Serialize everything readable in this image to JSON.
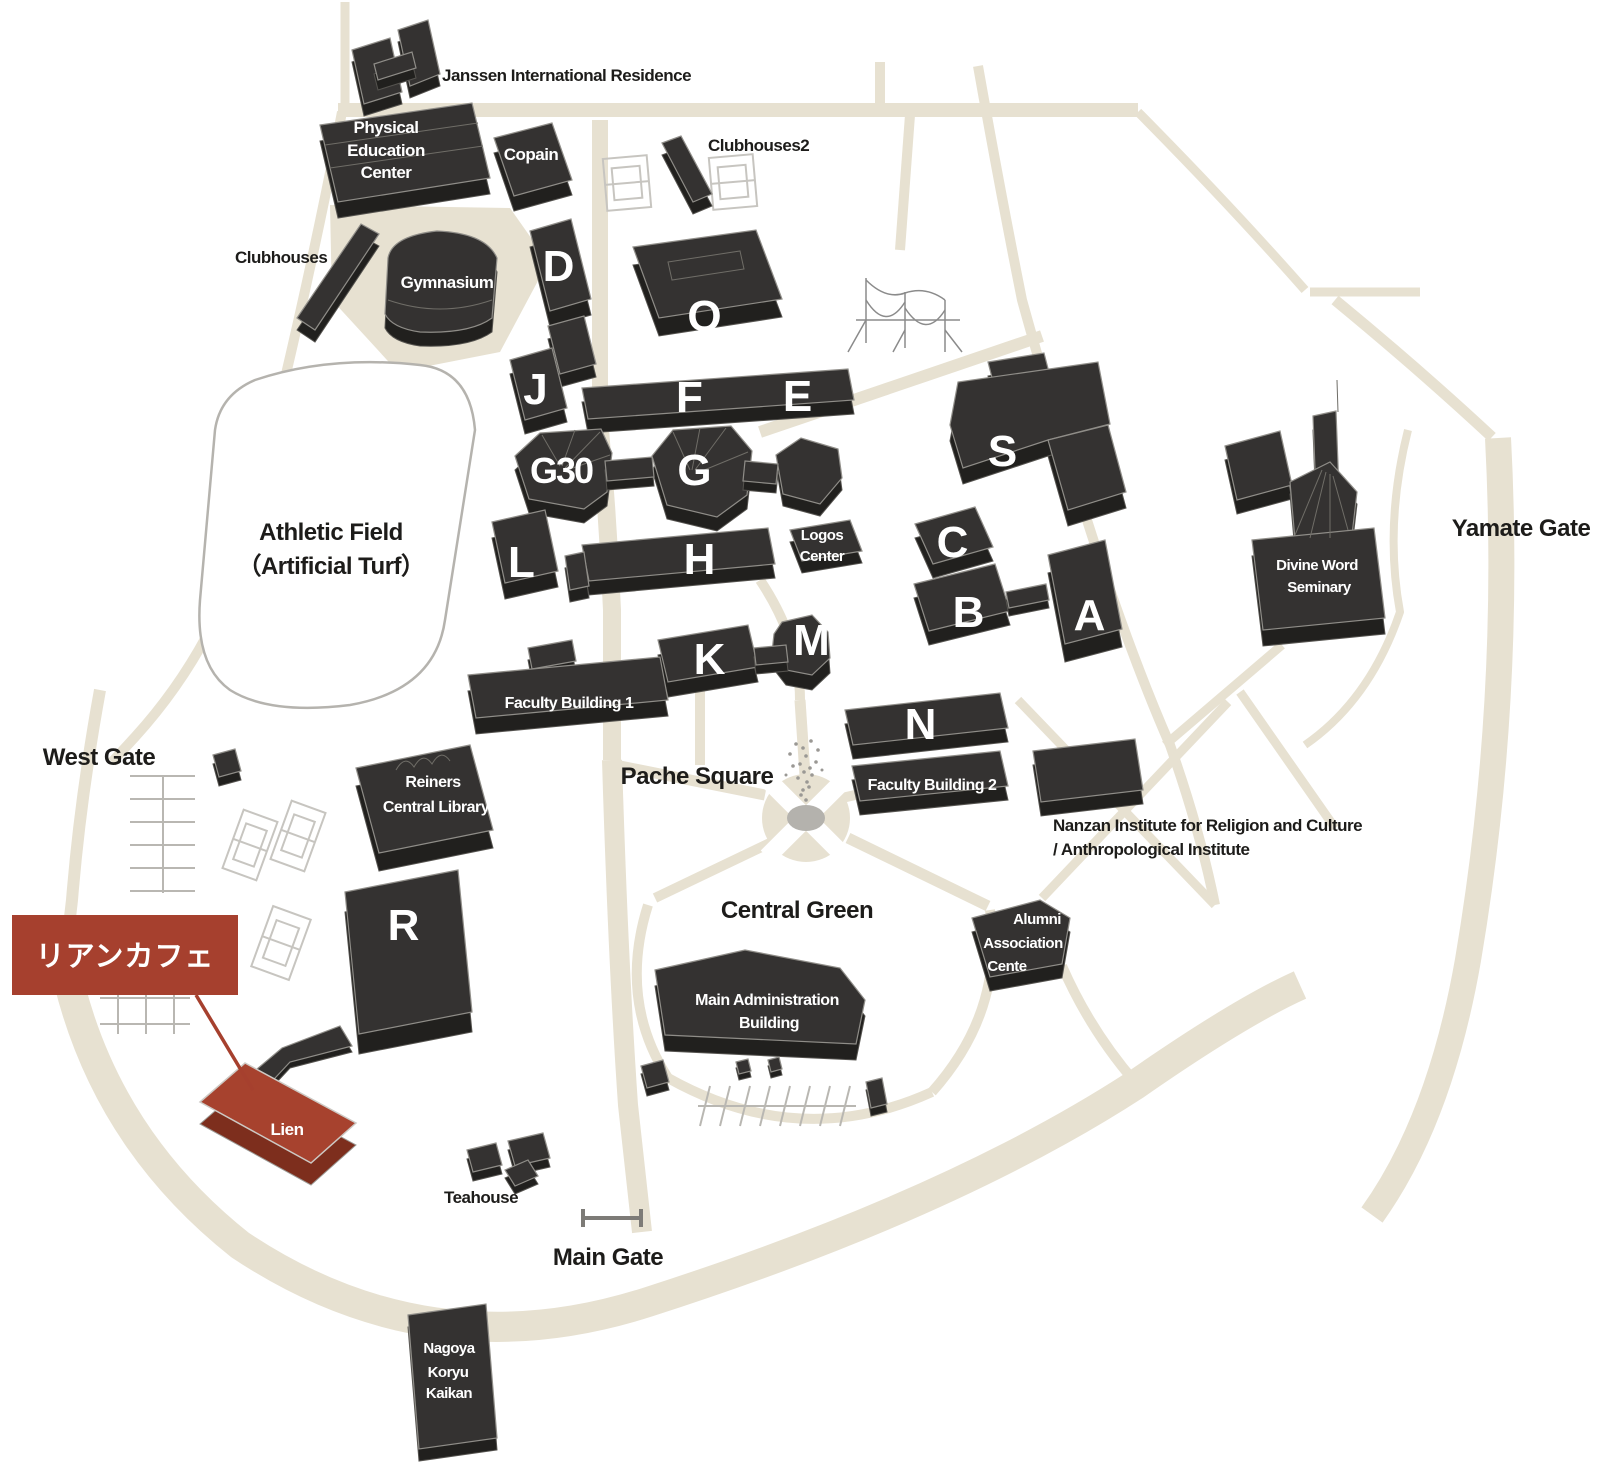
{
  "colors": {
    "background": "#ffffff",
    "road": "#e7e1d1",
    "building_top": "#343231",
    "building_side": "#21201e",
    "highlight_red": "#a7422e",
    "callout_red": "#a6402e",
    "label_dark": "#1d1c1a",
    "label_light": "#ffffff"
  },
  "area_labels": {
    "janssen": "Janssen International Residence",
    "clubhouses": "Clubhouses",
    "clubhouses2": "Clubhouses2",
    "athletic_line1": "Athletic Field",
    "athletic_line2": "（Artificial Turf）",
    "west_gate": "West Gate",
    "yamate_gate": "Yamate Gate",
    "main_gate": "Main Gate",
    "pache_square": "Pache Square",
    "central_green": "Central Green",
    "nanzan_line1": "Nanzan Institute for Religion and Culture",
    "nanzan_line2": "/ Anthropological Institute",
    "teahouse": "Teahouse"
  },
  "buildings": {
    "pe": [
      "Physical",
      "Education",
      "Center"
    ],
    "copain": "Copain",
    "gymnasium": "Gymnasium",
    "reiners": [
      "Reiners",
      "Central Library"
    ],
    "faculty1": "Faculty Building 1",
    "faculty2": "Faculty Building 2",
    "logos": [
      "Logos",
      "Center"
    ],
    "alumni": [
      "Alumni",
      "Association",
      "Cente"
    ],
    "admin": [
      "Main Administration",
      "Building"
    ],
    "divine": [
      "Divine Word",
      "Seminary"
    ],
    "nagoya": [
      "Nagoya",
      "Koryu",
      "Kaikan"
    ],
    "lien": "Lien"
  },
  "letters": {
    "d": "D",
    "j": "J",
    "q": "Q",
    "f": "F",
    "e": "E",
    "g30": "G30",
    "g": "G",
    "l": "L",
    "h": "H",
    "s": "S",
    "c": "C",
    "b": "B",
    "a": "A",
    "k": "K",
    "m": "M",
    "n": "N",
    "r": "R"
  },
  "callout": {
    "text": "リアンカフェ"
  }
}
